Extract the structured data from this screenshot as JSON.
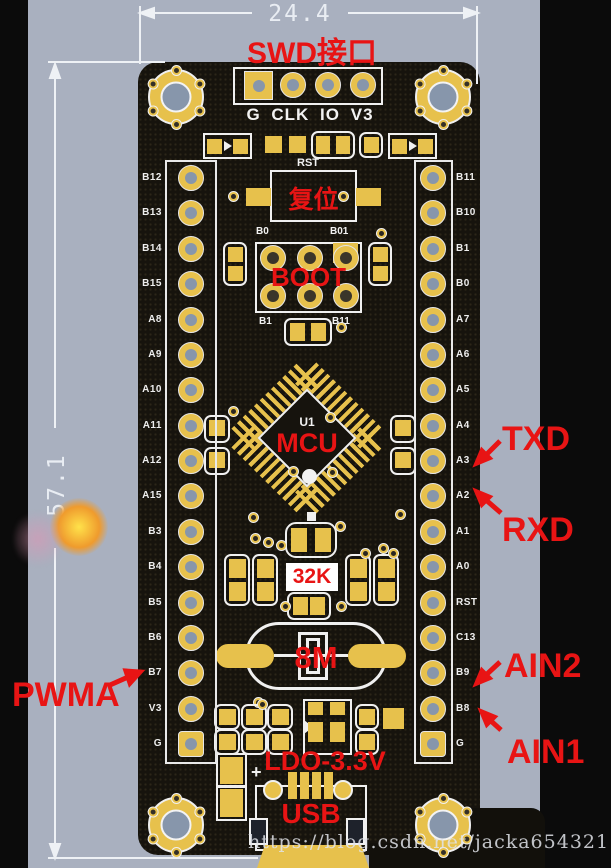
{
  "dimensions": {
    "width_mm": "24.4",
    "height_mm": "57.1"
  },
  "annotations": {
    "swd": "SWD接口",
    "reset": "复位",
    "boot": "BOOT",
    "mcu": "MCU",
    "crystal_32k": "32K",
    "crystal_8m": "8M",
    "ldo": "LDO-3.3V",
    "usb": "USB",
    "txd": "TXD",
    "rxd": "RXD",
    "ain2": "AIN2",
    "ain1": "AIN1",
    "pwma": "PWMA"
  },
  "silkscreen": {
    "swd_header": "G CLK IO V3",
    "reset_ref": "RST",
    "mcu_ref": "U1",
    "plus_mark": "+",
    "boot_labels": [
      "B0",
      "B01",
      "B1",
      "B11"
    ],
    "left_pins": [
      "B12",
      "B13",
      "B14",
      "B15",
      "A8",
      "A9",
      "A10",
      "A11",
      "A12",
      "A15",
      "B3",
      "B4",
      "B5",
      "B6",
      "B7",
      "V3",
      "G"
    ],
    "right_pins": [
      "B11",
      "B10",
      "B1",
      "B0",
      "A7",
      "A6",
      "A5",
      "A4",
      "A3",
      "A2",
      "A1",
      "A0",
      "RST",
      "C13",
      "B9",
      "B8",
      "G"
    ]
  },
  "watermark": "https://blog.csdn.net/jacka654321",
  "colors": {
    "background": "#a9b0bf",
    "board": "#16130d",
    "pad_gold": "#e7c14c",
    "silkscreen_white": "#f2f2f2",
    "annotation_red": "#e81414",
    "hole_gray": "#8796ab"
  }
}
